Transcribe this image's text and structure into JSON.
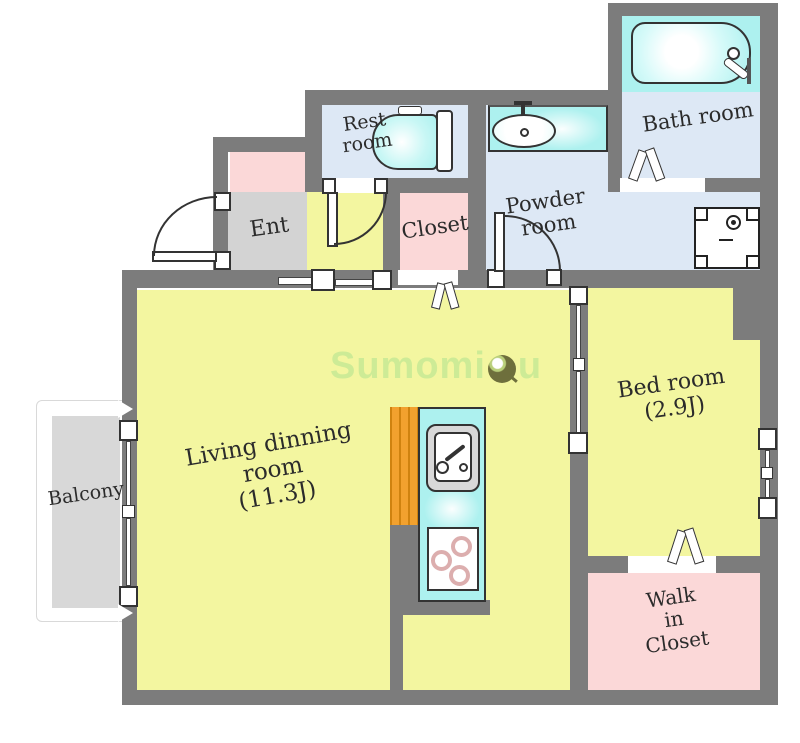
{
  "colors": {
    "wall": "#7c7c7c",
    "yellow": "#f3f6a0",
    "pink": "#fbd8d8",
    "blue": "#dde8f5",
    "cyan": "#adf1ef",
    "entgray": "#d3d3d3",
    "balgray": "#d8d8d8",
    "orange": "#f2a12e",
    "orangedark": "#cf820f",
    "burner": "#dcaeae",
    "ink": "#2b2b2b",
    "watermark": "#cdeb96"
  },
  "rooms": {
    "ent": {
      "label": "Ent"
    },
    "rest": {
      "label": "Rest\nroom"
    },
    "powder": {
      "label": "Powder\nroom"
    },
    "bath": {
      "label": "Bath room"
    },
    "closet": {
      "label": "Closet"
    },
    "living": {
      "label": "Living dinning\nroom\n(11.3J)"
    },
    "bedroom": {
      "label": "Bed room\n(2.9J)"
    },
    "walk_in_closet": {
      "label": "Walk\nin\nCloset"
    },
    "balcony": {
      "label": "Balcony"
    }
  },
  "watermark": {
    "part1": "Sumomi",
    "part2": "u"
  }
}
